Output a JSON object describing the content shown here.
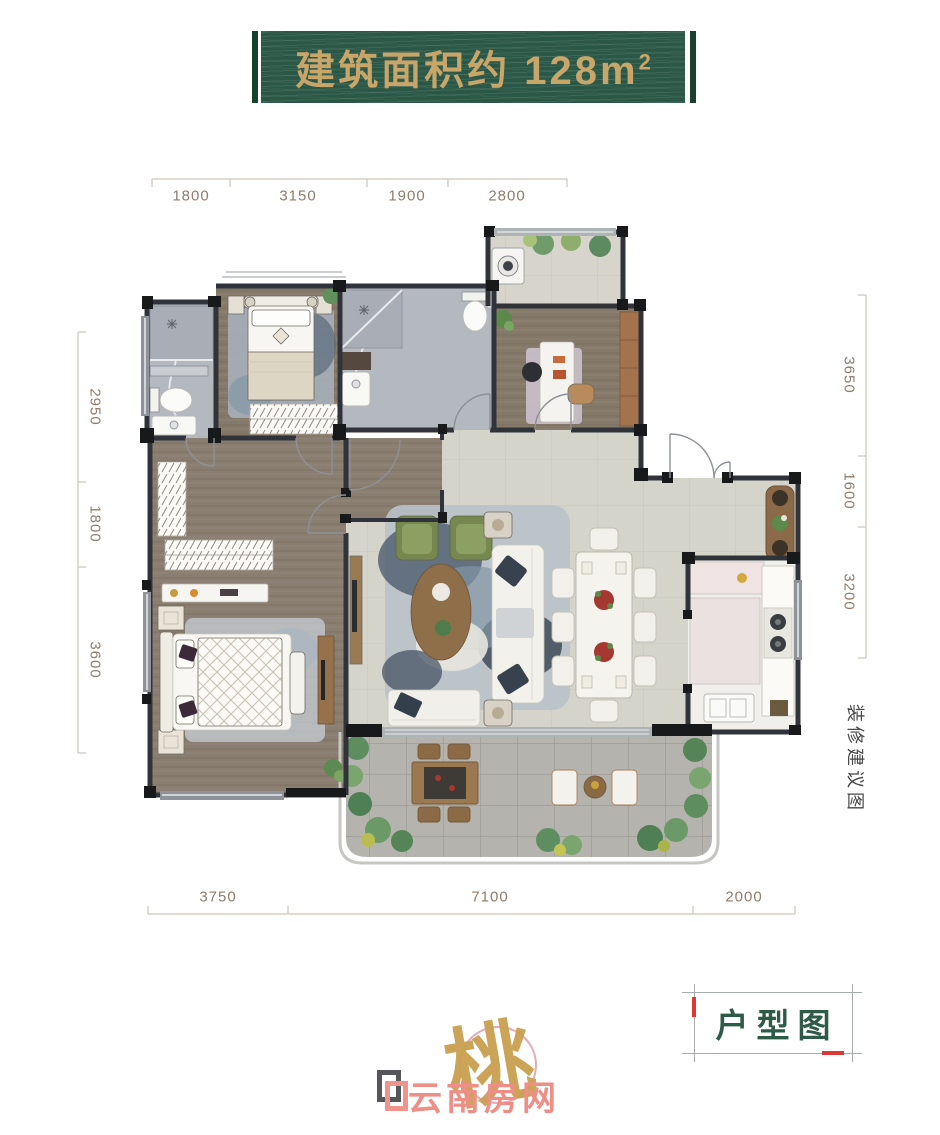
{
  "banner": {
    "label": "建筑面积约",
    "value": "128",
    "unit": "m",
    "sup": "2"
  },
  "dims": {
    "top": [
      "1800",
      "3150",
      "1900",
      "2800"
    ],
    "left": [
      "2950",
      "1800",
      "3600"
    ],
    "right": [
      "3650",
      "1600",
      "3200"
    ],
    "bottom": [
      "3750",
      "7100",
      "2000"
    ]
  },
  "labels": {
    "side_note": "装修建议图",
    "plan_label": "户型图"
  },
  "watermark": {
    "text": "云南房网",
    "seal_char": "桃"
  },
  "colors": {
    "banner_green": "#2b5747",
    "banner_gold": "#c8a568",
    "plan_label_green": "#2d5b47",
    "accent_red": "#d93a35",
    "dim_text": "#8f7c6c",
    "watermark_pink": "#ed8f86",
    "wall_dark": "#17191b",
    "wood_floor": "#8a7e71",
    "tile_floor": "#d5d4ca",
    "marble_floor": "#b4b8bf",
    "paver_floor": "#b5b3ad"
  }
}
